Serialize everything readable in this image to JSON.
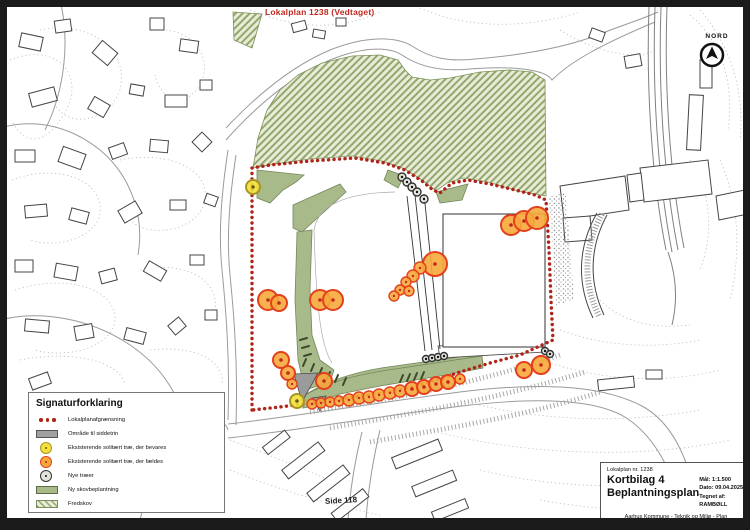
{
  "page": {
    "map_label": "Lokalplan 1238 (Vedtaget)",
    "side_label": "Side 118",
    "north_label": "NORD"
  },
  "legend": {
    "title": "Signaturforklaring",
    "items": [
      {
        "label": "Lokalplanafgrænsning",
        "symbol": "red-dots"
      },
      {
        "label": "Område til siddetrin",
        "symbol": "gray-rect"
      },
      {
        "label": "Eksisterende solitært træ, der bevares",
        "symbol": "yellow-circle"
      },
      {
        "label": "Eksisterende solitært træ, der fældes",
        "symbol": "orange-circle"
      },
      {
        "label": "Nye træer",
        "symbol": "new-tree-circle"
      },
      {
        "label": "Ny skovbeplantning",
        "symbol": "green-rect"
      },
      {
        "label": "Fredskov",
        "symbol": "hatch-rect"
      }
    ]
  },
  "title_block": {
    "plan_no": "Lokalplan nr. 1238",
    "sheet": "Kortbilag 4",
    "sheet_title": "Beplantningsplan",
    "scale": "Mål: 1:1.500",
    "date": "Dato: 09.04.2025",
    "drawn_by": "Tegnet af: RAMBØLL",
    "footer": "Aarhus Kommune - Teknik og Miljø - Plan"
  },
  "colors": {
    "boundary_red": "#b02318",
    "green_fill": "#a9ba8a",
    "green_stroke": "#75865a",
    "hatch_green": "#93a86d",
    "hatch_light": "#e7ebd8",
    "tree_keep_fill": "#f2e13c",
    "tree_keep_stroke": "#a8951f",
    "tree_keep_dot": "#6b5e10",
    "tree_fell_fill": "#f7a83c",
    "tree_fell_stroke": "#e4401c",
    "tree_fell_dot": "#c0281e",
    "tree_new_fill": "#e2e6da",
    "tree_new_stroke": "#333333",
    "seating_gray": "#9b9b9b"
  },
  "map": {
    "trees_keep": [
      [
        253,
        187,
        7
      ],
      [
        297,
        401,
        7
      ]
    ],
    "trees_fell": [
      [
        268,
        300,
        10
      ],
      [
        279,
        303,
        8
      ],
      [
        320,
        300,
        10
      ],
      [
        333,
        300,
        10
      ],
      [
        435,
        264,
        12
      ],
      [
        420,
        268,
        6
      ],
      [
        413,
        276,
        6
      ],
      [
        406,
        282,
        5
      ],
      [
        400,
        290,
        5
      ],
      [
        409,
        291,
        5
      ],
      [
        394,
        296,
        5
      ],
      [
        511,
        225,
        10
      ],
      [
        524,
        221,
        10
      ],
      [
        537,
        218,
        11
      ],
      [
        281,
        360,
        8
      ],
      [
        288,
        373,
        7
      ],
      [
        292,
        384,
        5
      ],
      [
        324,
        381,
        8
      ],
      [
        312,
        404,
        5
      ],
      [
        321,
        403,
        5
      ],
      [
        330,
        402,
        5
      ],
      [
        339,
        401,
        5
      ],
      [
        349,
        400,
        6
      ],
      [
        359,
        398,
        6
      ],
      [
        369,
        397,
        6
      ],
      [
        379,
        395,
        6
      ],
      [
        390,
        393,
        6
      ],
      [
        400,
        391,
        6
      ],
      [
        412,
        389,
        7
      ],
      [
        424,
        387,
        7
      ],
      [
        436,
        384,
        7
      ],
      [
        448,
        382,
        7
      ],
      [
        460,
        379,
        5
      ],
      [
        524,
        370,
        8
      ],
      [
        541,
        365,
        9
      ]
    ],
    "trees_new": [
      [
        402,
        177,
        4
      ],
      [
        407,
        182,
        4
      ],
      [
        412,
        187,
        4
      ],
      [
        417,
        192,
        4
      ],
      [
        424,
        199,
        4
      ],
      [
        426,
        359,
        3.5
      ],
      [
        432,
        358,
        3.5
      ],
      [
        438,
        357,
        3.5
      ],
      [
        444,
        356,
        3.5
      ],
      [
        545,
        351,
        3.5
      ],
      [
        550,
        354,
        3.5
      ]
    ]
  }
}
